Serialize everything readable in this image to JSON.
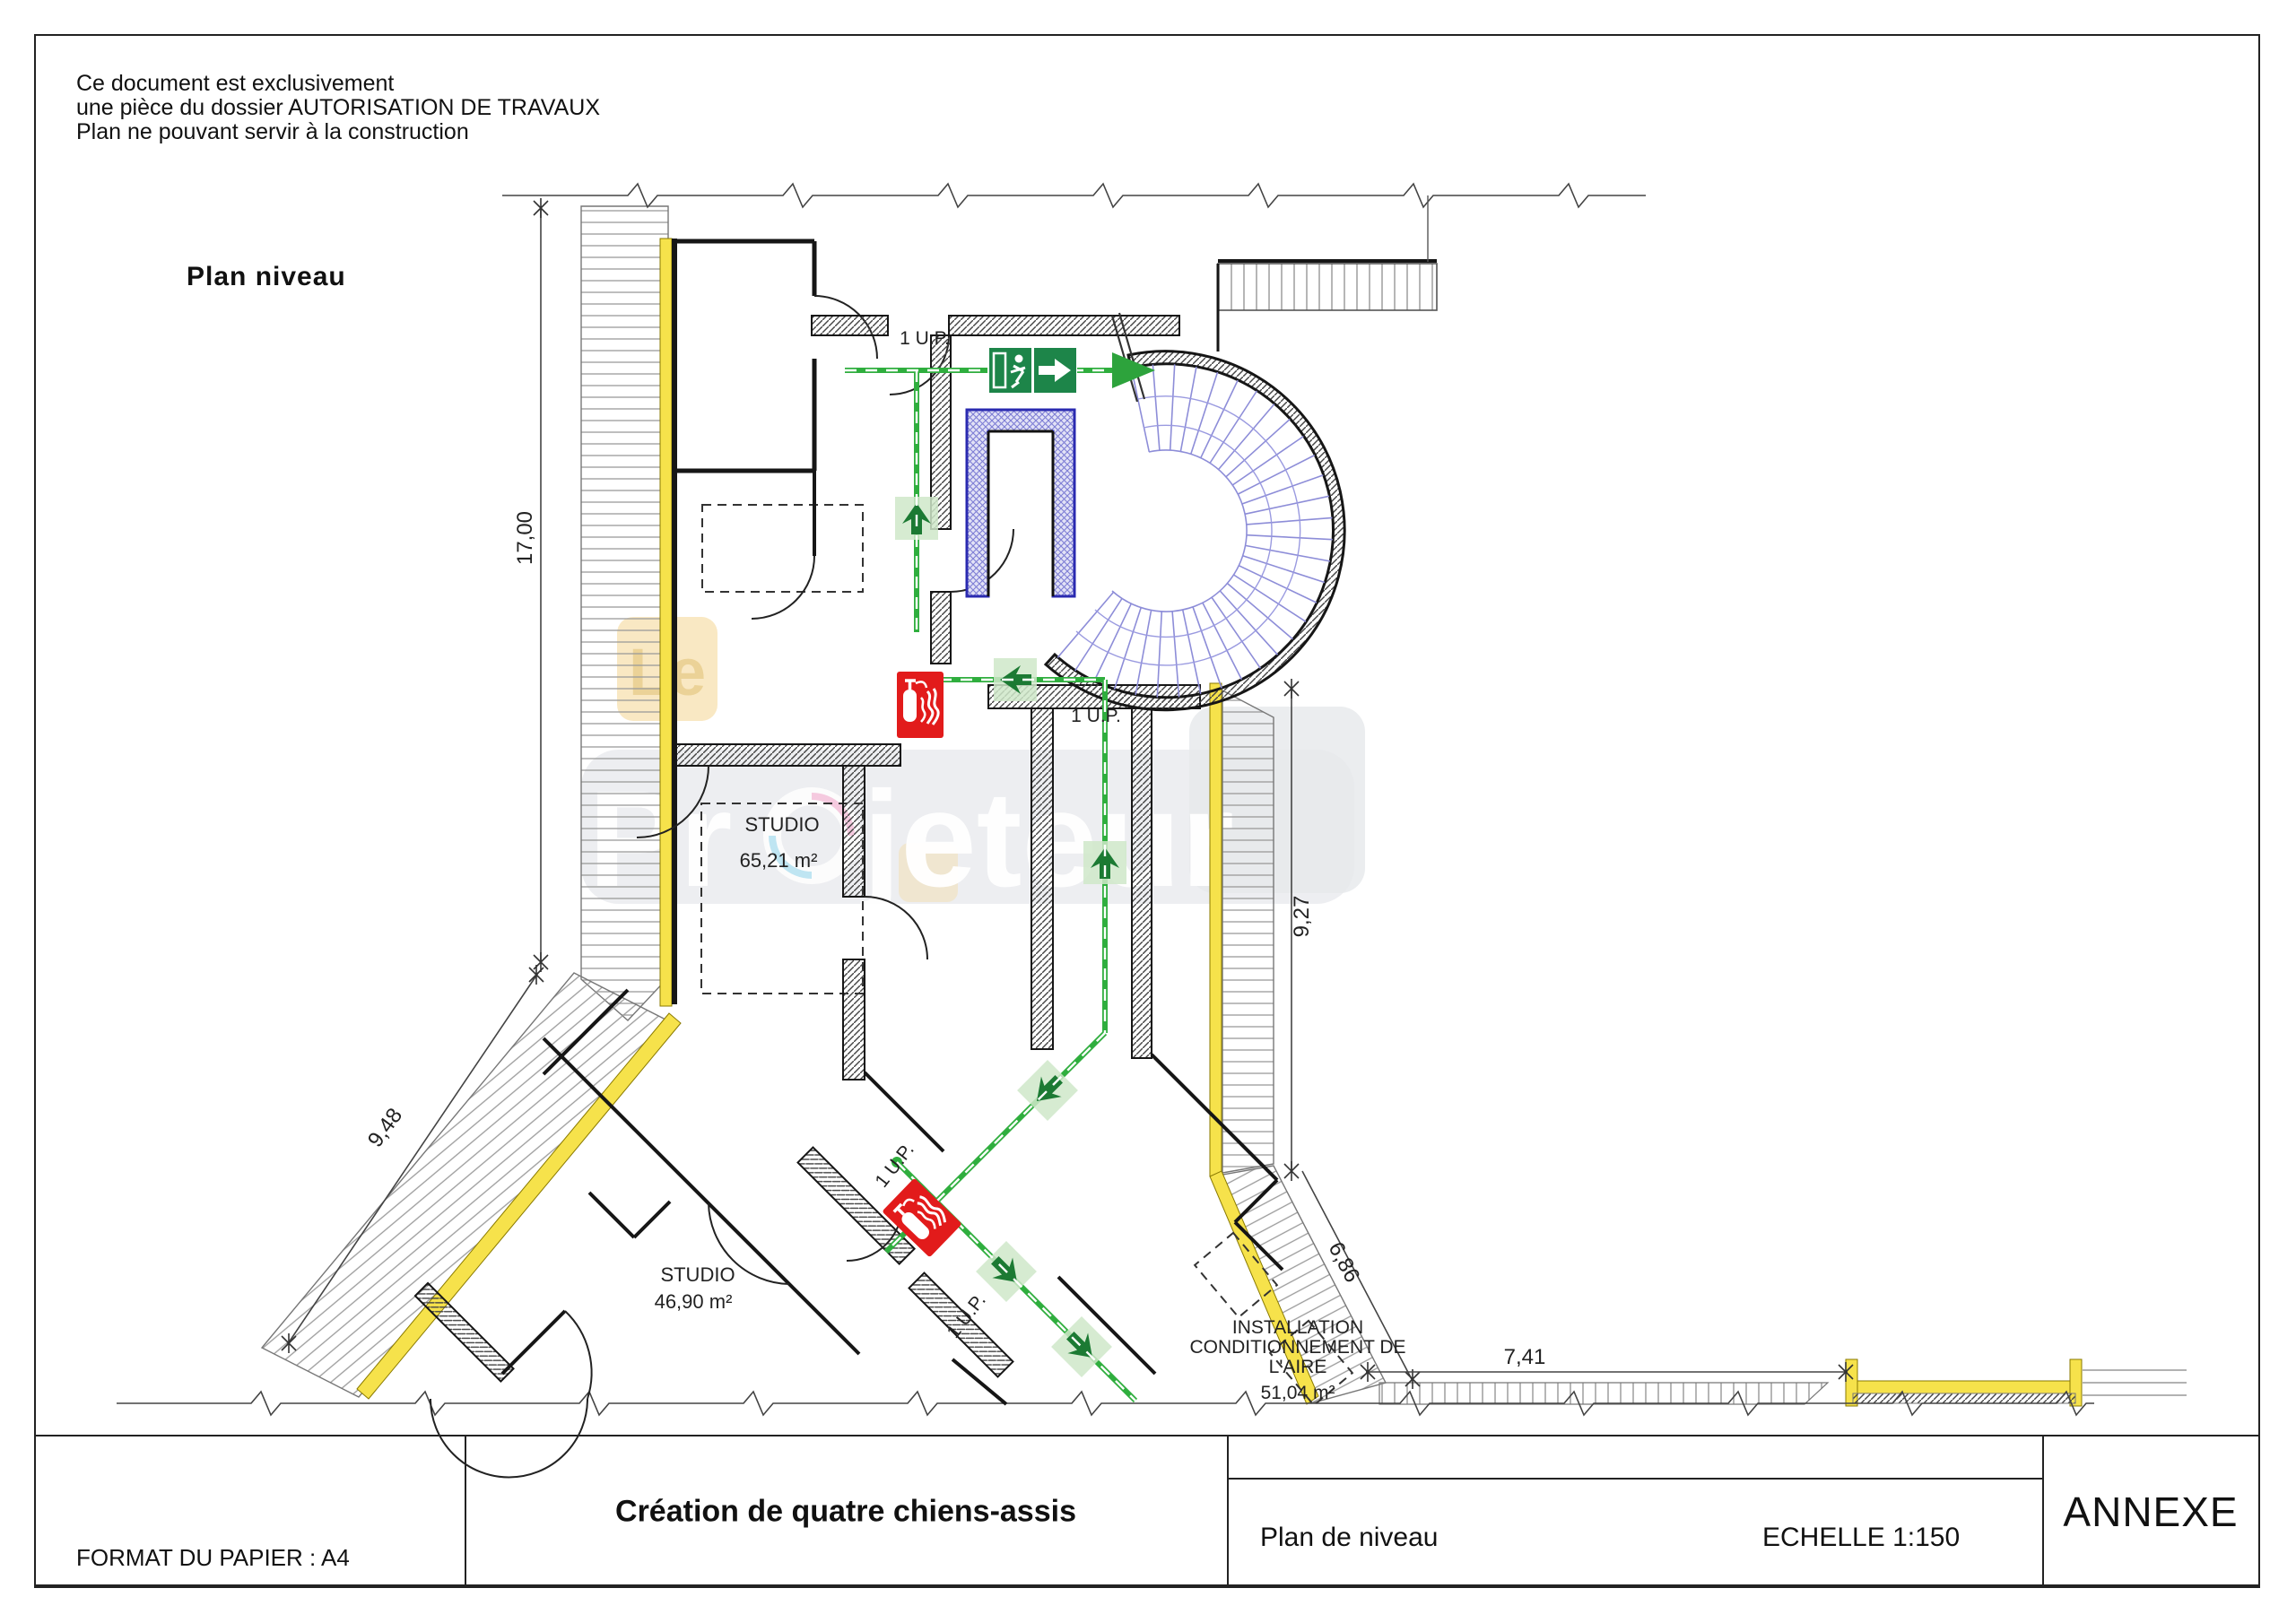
{
  "sheet": {
    "disclaimer": [
      "Ce document est exclusivement",
      "une pièce du dossier AUTORISATION DE TRAVAUX",
      "Plan ne pouvant servir à la construction"
    ],
    "plan_label": "Plan  niveau"
  },
  "title_block": {
    "paper_format": "FORMAT DU PAPIER : A4",
    "project_title": "Création de quatre chiens-assis",
    "drawing_name": "Plan de niveau",
    "scale_label": "ECHELLE 1:150",
    "annex_label": "ANNEXE"
  },
  "rooms": [
    {
      "name": "STUDIO",
      "area": "65,21 m²"
    },
    {
      "name": "STUDIO",
      "area": "46,90 m²"
    },
    {
      "name_lines": [
        "INSTALLATION",
        "CONDITIONNEMENT DE",
        "L'AIRE"
      ],
      "area": "51,04 m²"
    }
  ],
  "dimensions": {
    "left_height": "17,00",
    "left_diagonal": "9,48",
    "right_height": "9,27",
    "right_diagonal": "6,86",
    "bottom_width": "7,41"
  },
  "exit_unit_labels": [
    "1 U.P.",
    "1 U.P.",
    "1 U.P.",
    "1 U.P."
  ],
  "watermark": {
    "badge": "Le",
    "brand_part1": "Pr",
    "brand_part2": "jeteur"
  },
  "icons": {
    "exit_sign": "exit-running-man-with-arrow",
    "evacuation_arrow": "evacuation-direction-arrow",
    "fire_extinguisher": "fire-extinguisher"
  },
  "colors": {
    "highlight_wall_yellow": "#f6e24b",
    "evacuation_green": "#2fae3e",
    "exit_sign_green": "#1d8549",
    "fire_red": "#e21b1b",
    "stair_blue": "#8d8dd8",
    "elevator_blue": "#5757c8",
    "watermark_gray": "#e7e9ec"
  }
}
